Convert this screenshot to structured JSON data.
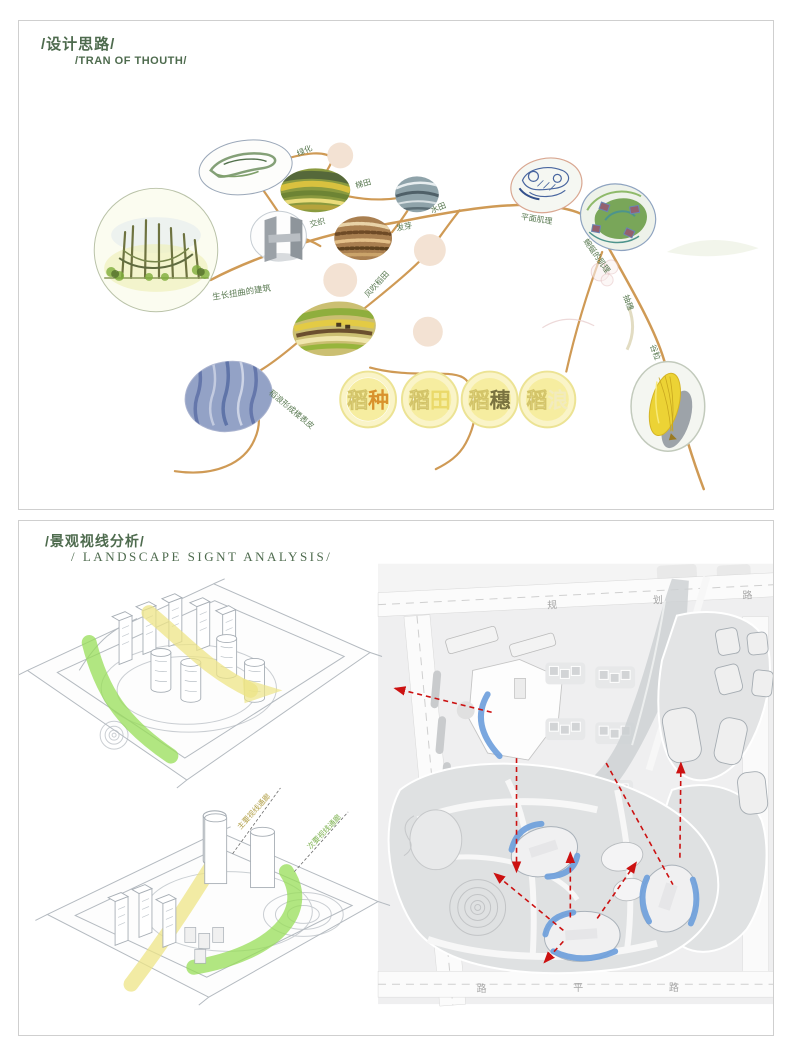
{
  "panel1": {
    "title_cn": "/设计思路/",
    "title_en": "/TRAN OF THOUTH/",
    "labels": {
      "greening": "绿化",
      "terrace": "梯田",
      "paddy": "水田",
      "interweave": "交织",
      "sprout": "发芽",
      "plan_texture": "平面肌理",
      "winding_texture": "蜿蜒的肌理",
      "growing_building": "生长扭曲的建筑",
      "wind_field": "风吹稻田",
      "wave_skin": "稻浪形成楼表皮",
      "heading": "抽穗",
      "grain": "谷粒"
    },
    "stages": [
      {
        "c1": "稻",
        "c2": "种",
        "accent": "#d9922d"
      },
      {
        "c1": "稻",
        "c2": "田",
        "accent": "#ead96a"
      },
      {
        "c1": "稻",
        "c2": "穗",
        "accent": "#7a7340"
      },
      {
        "c1": "稻",
        "c2": "浪",
        "accent": "#f2ebbe"
      }
    ],
    "colors": {
      "stem": "#cf9a55",
      "label": "#5a7a52",
      "title": "#4e6b4e"
    }
  },
  "panel2": {
    "title_cn": "/景观视线分析/",
    "title_en": "/ LANDSCAPE SIGNT ANALYSIS/",
    "axon_labels": {
      "main_corridor": "主要视线通廊",
      "secondary_corridor": "次要视线通廊"
    },
    "roads": {
      "top": "规划路",
      "bottom": "平路",
      "left": "路",
      "right": "路"
    },
    "colors": {
      "sight_main": "#ede486",
      "sight_secondary": "#97dd57",
      "view_arc": "#6fa0dc",
      "arrow": "#cc1111"
    }
  }
}
